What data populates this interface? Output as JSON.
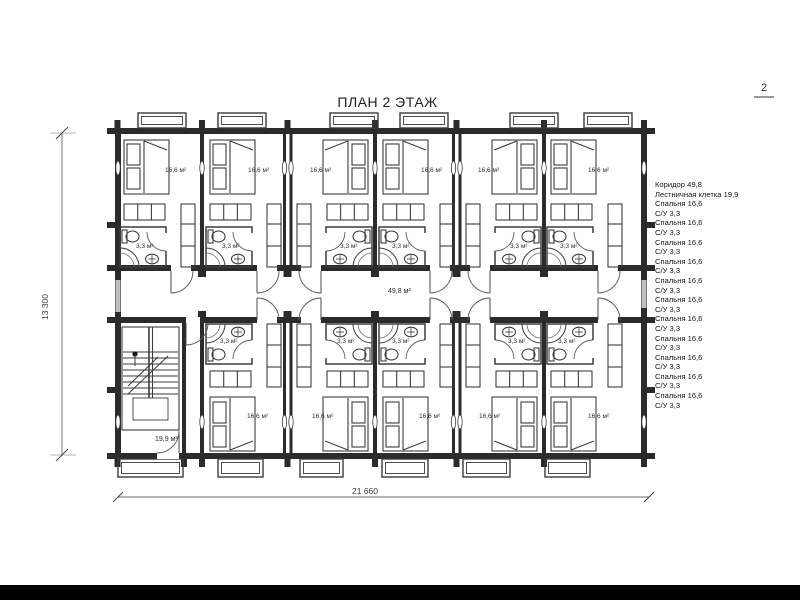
{
  "title": "ПЛАН 2 ЭТАЖ",
  "page": {
    "number": "2"
  },
  "dimensions": {
    "total_width": "21 660",
    "total_height": "13 300"
  },
  "plan": {
    "labels": {
      "bedroom": "16,6 м²",
      "bathroom": "3,3 м²",
      "corridor": "49,8 м²",
      "staircase": "19,9 м²"
    }
  },
  "legend": {
    "items": [
      "Коридор 49,8",
      "Лестничная клетка 19,9",
      "Спальня 16,6",
      "С/У 3,3",
      "Спальня 16,6",
      "С/У 3,3",
      "Спальня 16,6",
      "С/У 3,3",
      "Спальня 16,6",
      "С/У 3,3",
      "Спальня 16,6",
      "С/У 3,3",
      "Спальня 16,6",
      "С/У 3,3",
      "Спальня 16,6",
      "С/У 3,3",
      "Спальня 16,6",
      "С/У 3,3",
      "Спальня 16,6",
      "С/У 3,3",
      "Спальня 16,6",
      "С/У 3,3",
      "Спальня 16,6",
      "С/У 3,3"
    ]
  },
  "colors": {
    "wall": "#2b2b2b",
    "furniture_line": "#3d3d3d",
    "glazing": "#c0c0c0",
    "footer": "#000000"
  }
}
